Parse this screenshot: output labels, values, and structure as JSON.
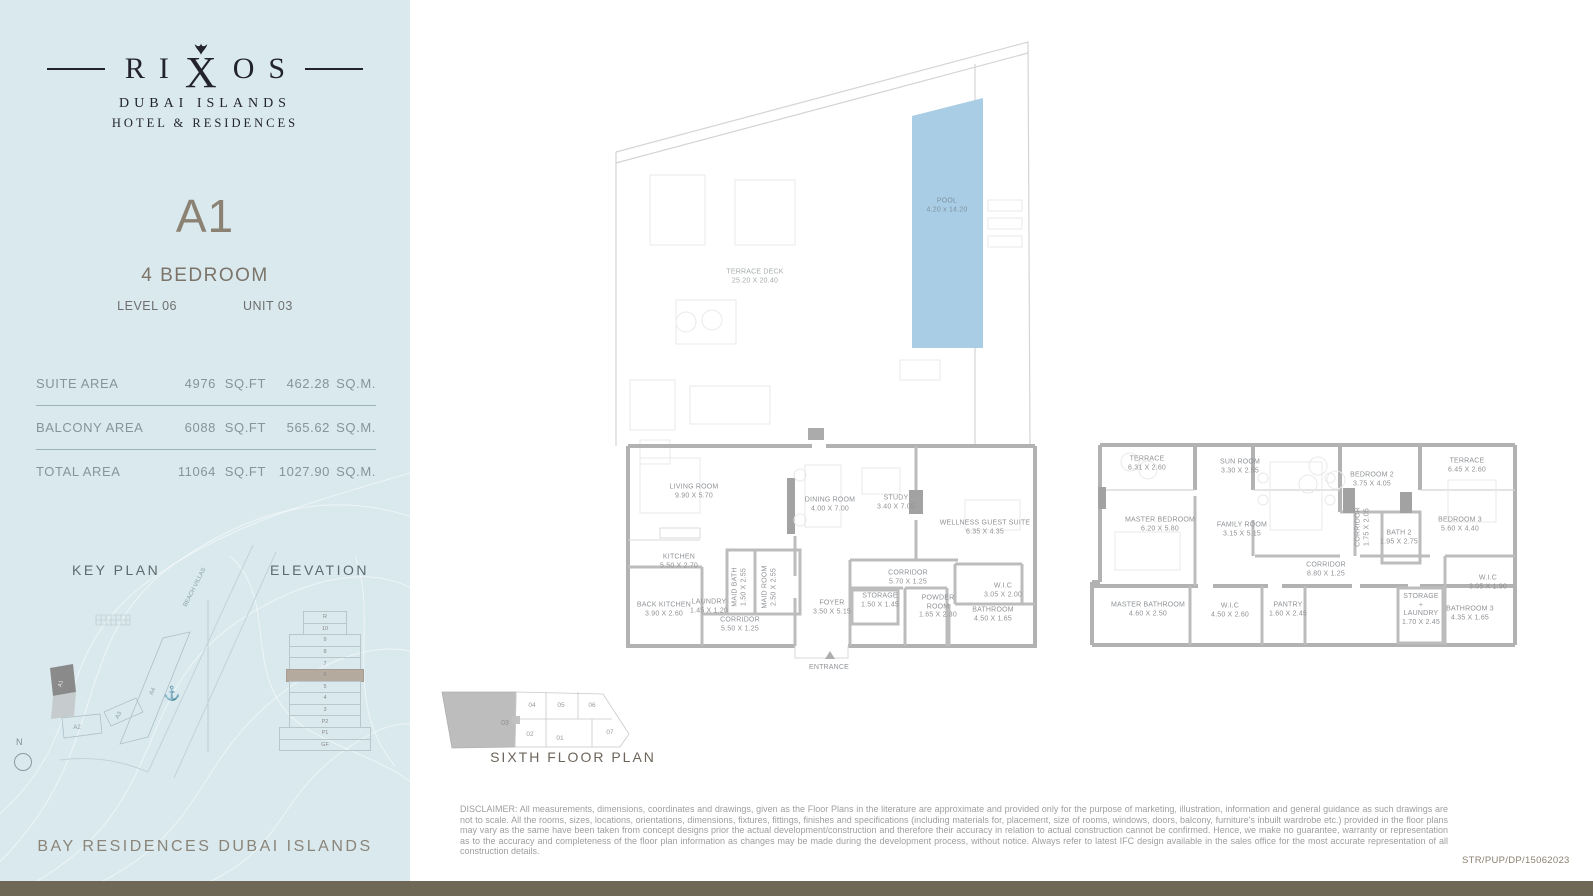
{
  "sidebar": {
    "brand": {
      "pre": "RI",
      "x": "X",
      "post": "OS",
      "line1": "DUBAI ISLANDS",
      "line2": "HOTEL & RESIDENCES"
    },
    "unit_code": "A1",
    "unit_type": "4 BEDROOM",
    "level_label": "LEVEL 06",
    "unit_label": "UNIT 03",
    "areas": [
      {
        "label": "SUITE AREA",
        "sqft": "4976",
        "sqft_unit": "SQ.FT",
        "sqm": "462.28",
        "sqm_unit": "SQ.M."
      },
      {
        "label": "BALCONY AREA",
        "sqft": "6088",
        "sqft_unit": "SQ.FT",
        "sqm": "565.62",
        "sqm_unit": "SQ.M."
      },
      {
        "label": "TOTAL AREA",
        "sqft": "11064",
        "sqft_unit": "SQ.FT",
        "sqm": "1027.90",
        "sqm_unit": "SQ.M."
      }
    ],
    "key_plan": {
      "title": "KEY PLAN",
      "buildings": [
        "A1",
        "A2",
        "A3",
        "A4"
      ],
      "road_label": "BEACH VILLAS"
    },
    "elevation": {
      "title": "ELEVATION",
      "floors": [
        "R",
        "10",
        "9",
        "8",
        "7",
        "6",
        "5",
        "4",
        "3",
        "P2",
        "P1",
        "GF"
      ],
      "highlighted_floor": "6"
    },
    "compass_label": "N",
    "footer": "BAY RESIDENCES DUBAI ISLANDS"
  },
  "plans": {
    "terrace": {
      "deck": {
        "name": "TERRACE DECK",
        "dims": "25.20 X 20.40"
      },
      "pool": {
        "name": "POOL",
        "dims": "4.20 x 14.20"
      }
    },
    "lower": {
      "rooms": [
        {
          "name": "LIVING ROOM",
          "dims": "9.90 X 5.70"
        },
        {
          "name": "DINING ROOM",
          "dims": "4.00 X 7.00"
        },
        {
          "name": "STUDY",
          "dims": "3.40 X 7.05"
        },
        {
          "name": "WELLNESS GUEST SUITE",
          "dims": "6.35 X 4.35"
        },
        {
          "name": "KITCHEN",
          "dims": "5.50 X 2.70"
        },
        {
          "name": "MAID BATH",
          "dims": "1.50 X 2.55"
        },
        {
          "name": "MAID ROOM",
          "dims": "2.50 X 2.55"
        },
        {
          "name": "BACK KITCHEN",
          "dims": "3.90 X 2.60"
        },
        {
          "name": "LAUNDRY",
          "dims": "1.45 X 1.20"
        },
        {
          "name": "CORRIDOR",
          "dims": "5.50 X 1.25"
        },
        {
          "name": "FOYER",
          "dims": "3.50 X 5.15"
        },
        {
          "name": "CORRIDOR",
          "dims": "5.70 X 1.25"
        },
        {
          "name": "STORAGE",
          "dims": "1.50 X 1.45"
        },
        {
          "name": "POWDER ROOM",
          "dims": "1.65 X 2.30"
        },
        {
          "name": "W.I.C",
          "dims": "3.05 X 2.00"
        },
        {
          "name": "BATHROOM",
          "dims": "4.50 X 1.65"
        },
        {
          "name": "ENTRANCE",
          "dims": ""
        }
      ]
    },
    "upper": {
      "rooms": [
        {
          "name": "TERRACE",
          "dims": "6.31 X 2.60"
        },
        {
          "name": "SUN ROOM",
          "dims": "3.30 X 2.55"
        },
        {
          "name": "BEDROOM 2",
          "dims": "3.75 X 4.05"
        },
        {
          "name": "TERRACE",
          "dims": "6.45 X 2.60"
        },
        {
          "name": "MASTER BEDROOM",
          "dims": "6.20 X 5.80"
        },
        {
          "name": "FAMILY ROOM",
          "dims": "3.15 X 5.15"
        },
        {
          "name": "CORRIDOR",
          "dims": "1.75 X 2.05"
        },
        {
          "name": "BATH 2",
          "dims": "1.95 X 2.75"
        },
        {
          "name": "BEDROOM 3",
          "dims": "5.60 X 4.40"
        },
        {
          "name": "CORRIDOR",
          "dims": "8.80 X 1.25"
        },
        {
          "name": "MASTER BATHROOM",
          "dims": "4.60 X 2.50"
        },
        {
          "name": "W.I.C",
          "dims": "4.50 X 2.60"
        },
        {
          "name": "PANTRY",
          "dims": "1.60 X 2.45"
        },
        {
          "name": "STORAGE + LAUNDRY",
          "dims": "1.70 X 2.45"
        },
        {
          "name": "W.I.C",
          "dims": "3.05 X 1.90"
        },
        {
          "name": "BATHROOM 3",
          "dims": "4.35 X 1.65"
        }
      ]
    }
  },
  "floor_key": {
    "title": "SIXTH FLOOR PLAN",
    "highlighted_unit": "03",
    "units": [
      "03",
      "04",
      "05",
      "06",
      "02",
      "01",
      "07"
    ]
  },
  "disclaimer": "DISCLAIMER: All measurements, dimensions, coordinates and drawings, given as the Floor Plans in the literature are approximate and provided only for the purpose of marketing, illustration, information and general guidance as such drawings are not to scale. All the rooms, sizes, locations, orientations, dimensions, fixtures, fittings, finishes and specifications (including materials for, placement, size of rooms, windows, doors, balcony, furniture's inbuilt wardrobe etc.) provided in the floor plans may vary as the same have been taken from concept designs prior the actual development/construction and therefore their accuracy in relation to actual construction cannot be confirmed. Hence, we make no guarantee, warranty or representation as to the accuracy and completeness of the floor plan information as changes may be made during the development process, without notice. Always refer to latest IFC design available  in the sales office for the most accurate representation of all construction details.",
  "doc_code": "STR/PUP/DP/15062023"
}
